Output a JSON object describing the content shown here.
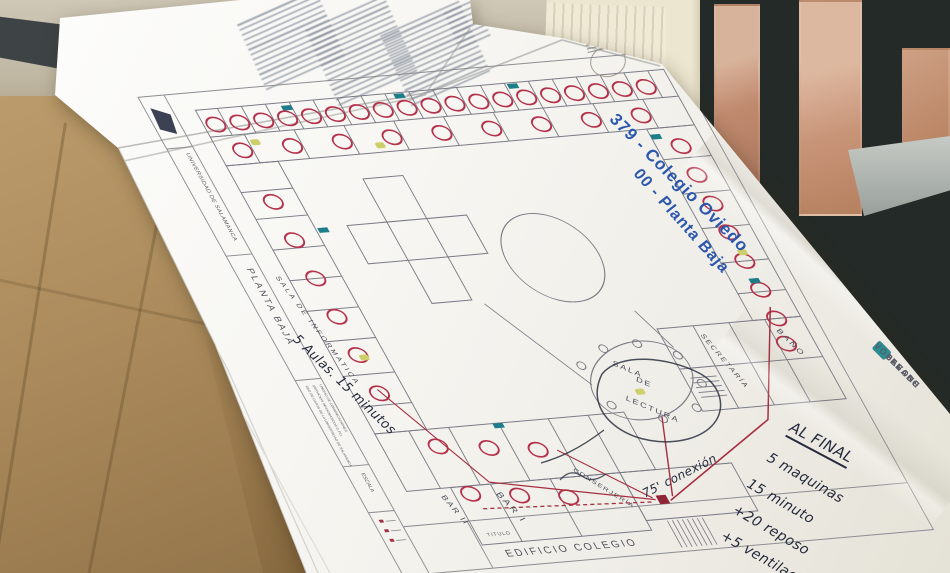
{
  "photo": {
    "plan_sheet": {
      "blue_title": {
        "line1": "379 - Colegio Oviedo",
        "line2": "00 - Planta Baja"
      },
      "margin": {
        "university": "UNIVERSIDAD DE SALAMANCA",
        "floor": "PLANTA BAJA",
        "org_line1": "RED DE DATOS DE LA UNIVERSIDAD DE SALAMANCA",
        "org_line2": "SERVICIOS INFORMATICOS C.P.D.",
        "org_line3": "UNIDAD DE COMUNICACIONES",
        "escala": "ESCALA",
        "titulo": "TITULO",
        "edificio": "EDIFICIO COLEGIO"
      },
      "rooms": {
        "informatica": "SALA DE INFORMATICA",
        "lectura_1": "SALA",
        "lectura_2": "DE",
        "lectura_3": "LECTURA",
        "secretaria": "SECRETARÍA",
        "bano": "BAÑO",
        "bar1": "BAR I",
        "bar2": "BAR II",
        "conserjeria": "CONSERJERÍA"
      },
      "legend": {
        "antenas": "ANTENAS",
        "cableado": "CABLEADO",
        "vodafone": "VODAFONE"
      },
      "colors": {
        "blue_title": "#2b57ad",
        "red_marker": "#b5304a",
        "teal_marker": "#1f7d8a",
        "yellow_marker": "#cdd06a",
        "ink": "#252a3d"
      }
    },
    "handwriting": {
      "final_title": "AL FINAL",
      "final_notes": [
        "5 maquinas",
        "15 minuto",
        "+20 reposo",
        "+5 ventilación"
      ],
      "aulas_note": "5 Aulas. 15 minutos",
      "conexion_note": "75' conexión"
    }
  }
}
